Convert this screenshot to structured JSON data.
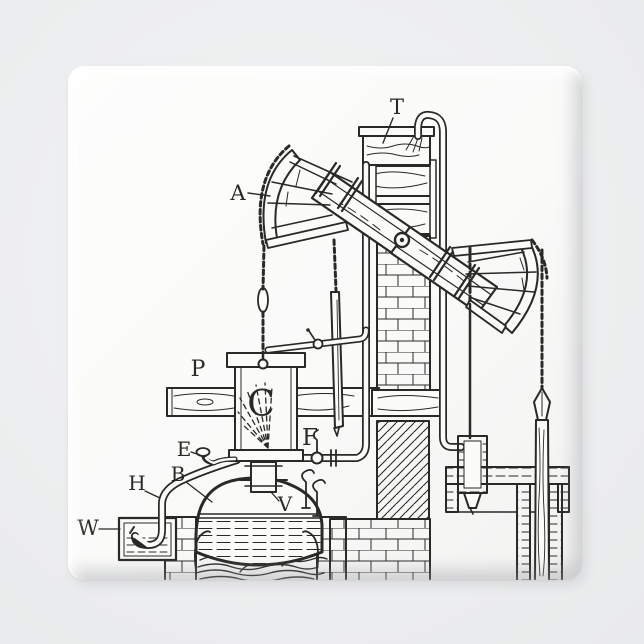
{
  "scene": {
    "background_color": "#eff0f1",
    "magnet_face_color": "#fafaf9",
    "ink_color": "#2b2926"
  },
  "figure": {
    "labels": {
      "arch_head": "A",
      "water_tank": "T",
      "piston": "P",
      "cylinder": "C",
      "injection_pipe": "F",
      "snifting_valve": "E",
      "boiler": "B",
      "eduction_pipe": "H",
      "waste_well": "W",
      "steam_valve": "V"
    }
  }
}
